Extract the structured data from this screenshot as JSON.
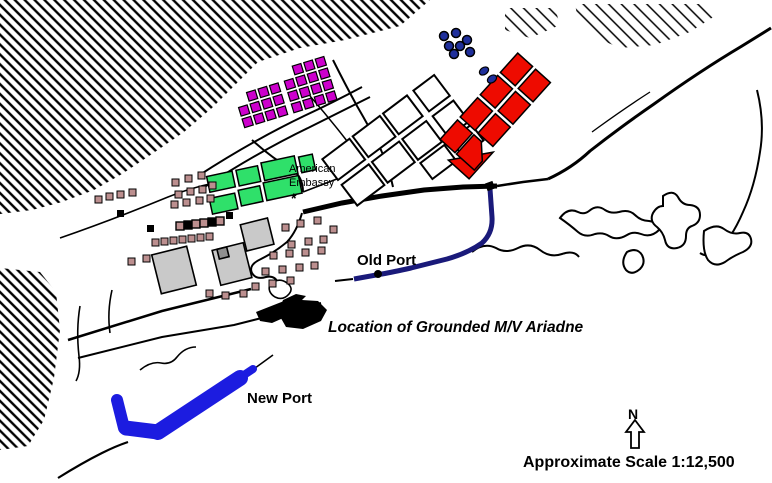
{
  "map": {
    "labels": {
      "embassy_line1": "American",
      "embassy_line2": "Embassy",
      "embassy_marker": "*",
      "old_port": "Old Port",
      "ship_location": "Location of Grounded M/V Ariadne",
      "new_port": "New Port",
      "compass_north": "N",
      "scale": "Approximate Scale 1:12,500"
    },
    "colors": {
      "paper": "#ffffff",
      "ink": "#000000",
      "magenta_blocks": "#cc00cc",
      "red_blocks": "#ee0b00",
      "green_blocks": "#2fe06a",
      "brown_buildings": "#bc8f8f",
      "gray_buildings": "#c9c9c9",
      "dark_gray_building": "#8f8f8f",
      "blue_dot_buildings": "#1f2f9b",
      "old_port_breakwater": "#1a1a7a",
      "new_port_pier": "#1c1ce0"
    }
  }
}
